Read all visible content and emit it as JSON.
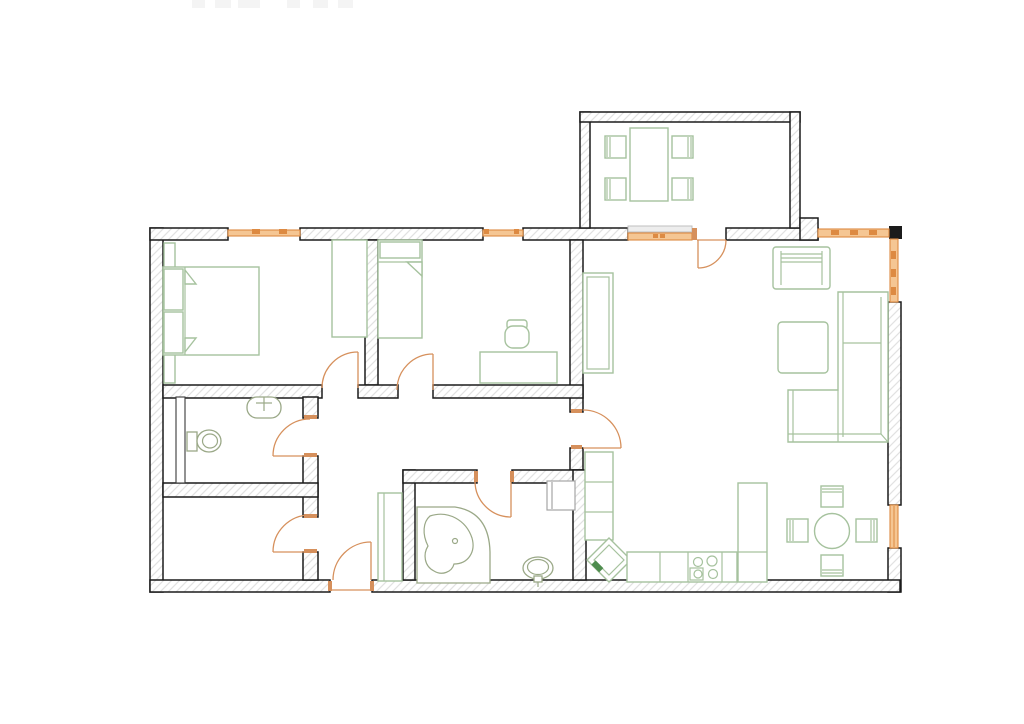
{
  "canvas": {
    "width": 1024,
    "height": 724,
    "background": "#ffffff"
  },
  "colors": {
    "wall": "#1b1b1b",
    "hatch_line": "#e2e2e2",
    "furniture": "#a6c29e",
    "fixture": "#9aa887",
    "door": "#d6905c",
    "window_fill": "#f5c693",
    "window_accent": "#dd8a42",
    "appliance": "#a5a5a5",
    "accent_green": "#4e8c4e",
    "artifact": "#f4f4f4",
    "background": "#ffffff"
  },
  "plan": {
    "label": "Apartment floor plan drawing",
    "type": "apartment-floor-plan",
    "doors_count": 8,
    "windows_count": 6,
    "rooms": [
      {
        "name": "bedroom-1",
        "items": [
          "double-bed",
          "pillows",
          "side-shelf",
          "wardrobe"
        ]
      },
      {
        "name": "bedroom-2",
        "items": [
          "single-bed",
          "desk",
          "desk-chair"
        ]
      },
      {
        "name": "bathroom-1",
        "items": [
          "washbasin",
          "toilet",
          "partition-screen"
        ]
      },
      {
        "name": "storage-room",
        "items": []
      },
      {
        "name": "hallway",
        "items": [
          "wardrobe",
          "entrance-door"
        ]
      },
      {
        "name": "bathroom-2",
        "items": [
          "corner-bathtub",
          "washbasin",
          "washing-machine"
        ]
      },
      {
        "name": "kitchen",
        "items": [
          "counter-run",
          "corner-sink",
          "cooktop",
          "tall-cabinet"
        ]
      },
      {
        "name": "living-room",
        "items": [
          "sideboard",
          "loveseat",
          "coffee-table",
          "corner-sofa",
          "round-table",
          "four-chairs"
        ]
      },
      {
        "name": "balcony",
        "items": [
          "dining-table",
          "four-chairs"
        ]
      }
    ],
    "header_artifact": "illegible cropped text at top edge"
  }
}
